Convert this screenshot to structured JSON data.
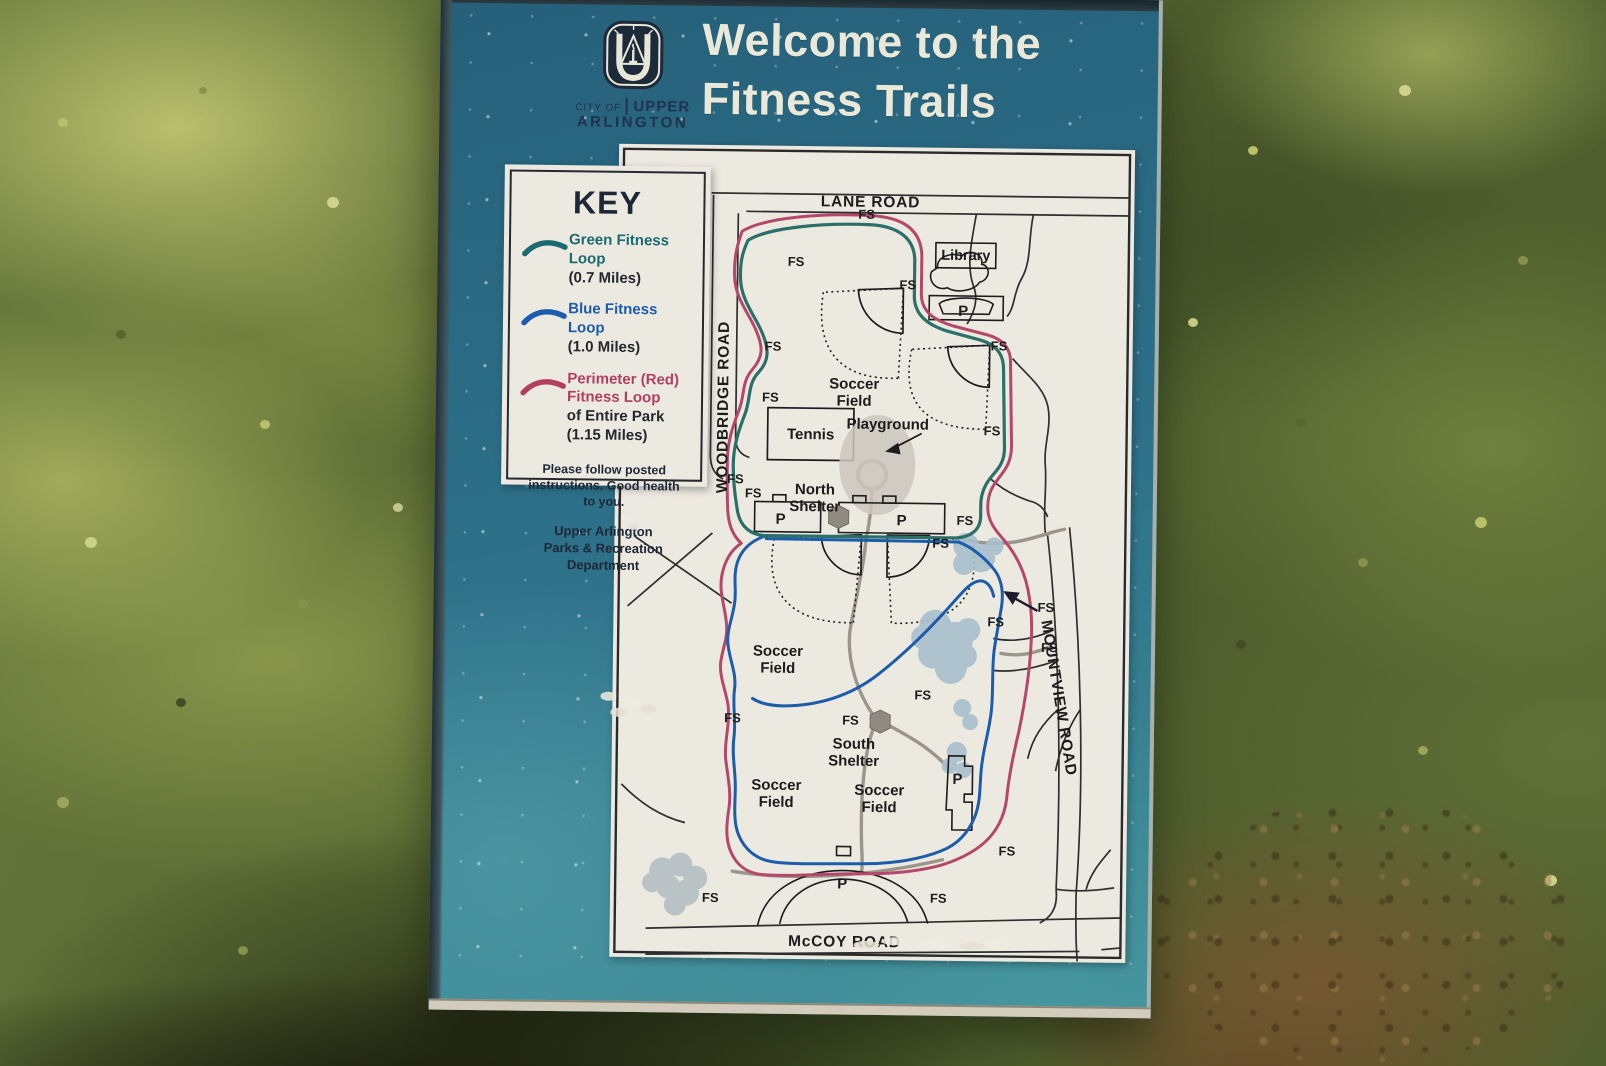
{
  "header": {
    "city_of": "CITY OF",
    "city_upper": "UPPER",
    "city_arlington": "ARLINGTON",
    "title_line1": "Welcome to the",
    "title_line2": "Fitness Trails"
  },
  "key": {
    "heading": "KEY",
    "items": [
      {
        "label": "Green Fitness Loop",
        "detail": "(0.7 Miles)",
        "color": "#1b6a70"
      },
      {
        "label": "Blue Fitness Loop",
        "detail": "(1.0 Miles)",
        "color": "#1d5cab"
      },
      {
        "label_lines": [
          "Perimeter (Red)",
          "Fitness Loop"
        ],
        "detail_lines": [
          "of Entire Park",
          "(1.15 Miles)"
        ],
        "color": "#b23f60"
      }
    ],
    "note_lines": [
      "Please follow posted",
      "instructions.  Good health",
      "to you."
    ],
    "dept_lines": [
      "Upper Arlington",
      "Parks & Recreation",
      "Department"
    ]
  },
  "map": {
    "roads": {
      "lane": "LANE ROAD",
      "woodbridge": "WOODBRIDGE ROAD",
      "mountview": "MOUNTVIEW ROAD",
      "mccoy": "McCOY ROAD"
    },
    "labels": {
      "library": "Library",
      "tennis": "Tennis",
      "playground": "Playground",
      "soccer_field": [
        "Soccer",
        "Field"
      ],
      "north_shelter": [
        "North",
        "Shelter"
      ],
      "south_shelter": [
        "South",
        "Shelter"
      ]
    },
    "fs_label": "FS",
    "parking_label": "P",
    "trail_colors": {
      "green": "#2a6f68",
      "blue": "#1d5cab",
      "red": "#b5476a"
    }
  },
  "colors": {
    "sign_teal": "#2d7089",
    "sign_text_cream": "#eae8d8",
    "logo_navy": "#20324e",
    "panel_paper": "#ece9e0"
  }
}
